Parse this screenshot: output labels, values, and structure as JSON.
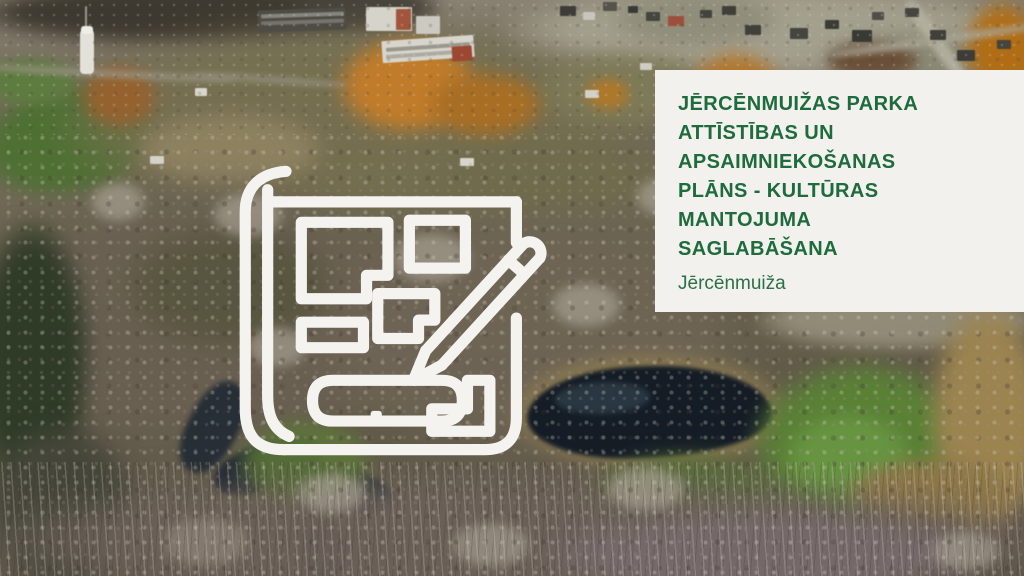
{
  "panel": {
    "title": "JĒRCĒNMUIŽAS PARKA\nATTĪSTĪBAS UN\nAPSAIMNIEKOŠANAS\nPLĀNS - KULTŪRAS\nMANTOJUMA\nSAGLABĀŠANA",
    "subtitle": "Jērcēnmuiža",
    "colors": {
      "panel_background": "#f2f1ed",
      "title": "#1e6b3d",
      "subtitle": "#2b7049"
    }
  },
  "overlay_icon": {
    "name": "site-plan-with-pencil-icon",
    "color": "#f4f3ef"
  },
  "photo": {
    "alt": "Autumn aerial view of Jērcēnmuiža park: dark pond, green meadows, bare grey trees, allotment fields and village apartment blocks with orange foliage"
  }
}
